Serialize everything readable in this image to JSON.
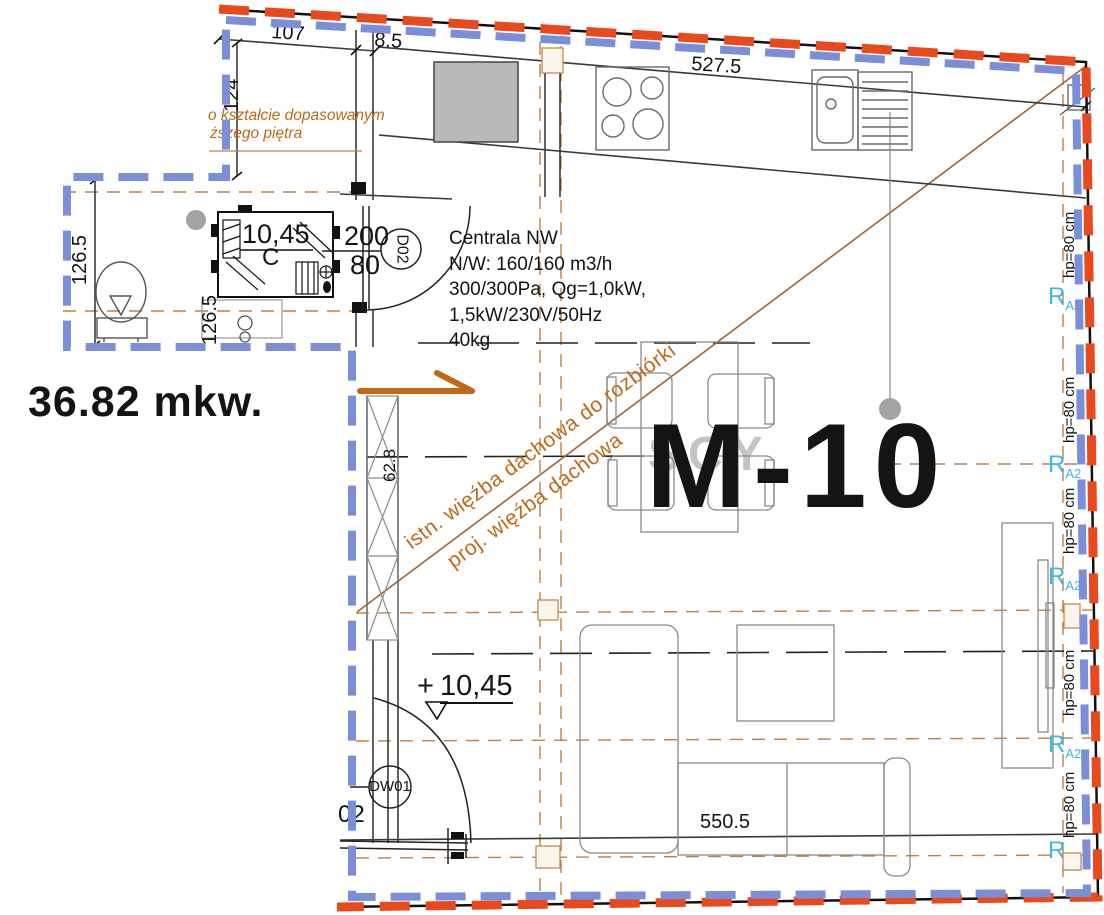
{
  "colors": {
    "red": "#e8491d",
    "blue": "#7b8fd8",
    "orange-text": "#c06818",
    "construction": "#c08040",
    "roofline": "#a06434",
    "cyan": "#3fb6e4",
    "gray-dot": "#a3a3a3"
  },
  "labels": {
    "area": "36.82 mkw.",
    "unit": "M-10",
    "watermark": "SCY",
    "top_note1": "o kształcie dopasowanym",
    "top_note2": "ższego piętra",
    "roof_note1": "istn. więźba dachowa do rozbiórki",
    "roof_note2": "proj. więźba dachowa",
    "hvac1": "Centrala NW",
    "hvac2": "N/W: 160/160 m3/h",
    "hvac3": "300/300Pa, Qg=1,0kW,",
    "hvac4": "1,5kW/230V/50Hz",
    "hvac5": "40kg",
    "level_bath": "10,45",
    "level_main_plus": "+",
    "level_main": "10,45",
    "section_c": "C",
    "door_d02": "D02",
    "door_dw01": "DW01",
    "cut_02": "02"
  },
  "dimensions": {
    "w107": "107",
    "w85": "8.5",
    "w5275": "527.5",
    "h124": "124",
    "h1265_left": "126.5",
    "h1265_mid": "126.5",
    "h628": "62.8",
    "door_w200": "200",
    "door_h80": "80",
    "w5505": "550.5"
  },
  "windows": {
    "sill": "hp=80 cm",
    "marker": "R",
    "marker_sub": "A2"
  }
}
